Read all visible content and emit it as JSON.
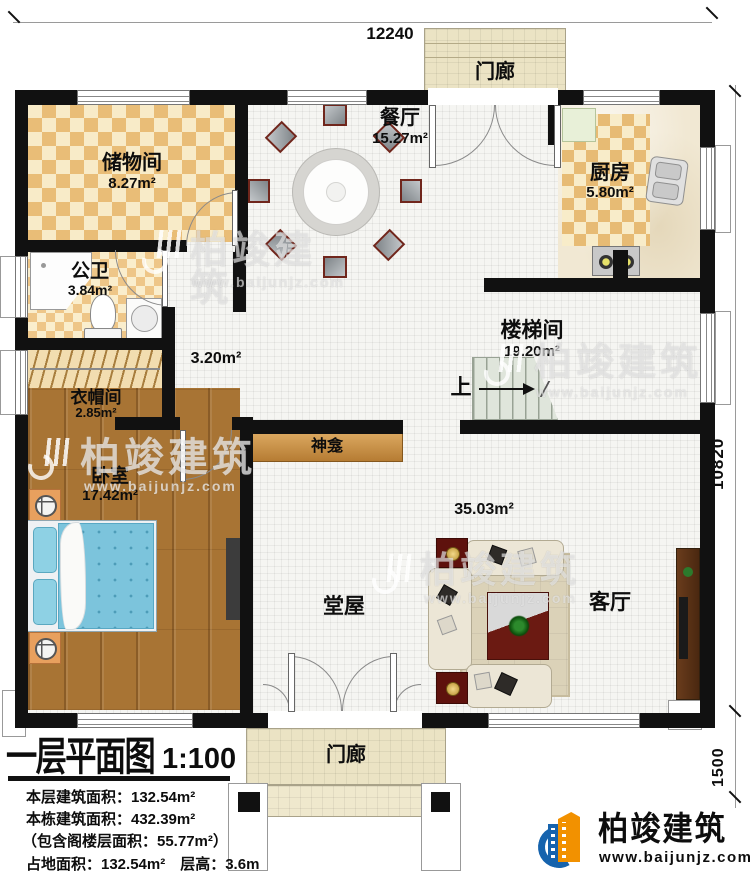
{
  "dimensions": {
    "top": "12240",
    "right_main": "10820",
    "right_porch": "1500"
  },
  "rooms": {
    "storage": {
      "name": "储物间",
      "area": "8.27m²"
    },
    "dining": {
      "name": "餐厅",
      "area": "15.27m²"
    },
    "kitchen": {
      "name": "厨房",
      "area": "5.80m²"
    },
    "bath": {
      "name": "公卫",
      "area": "3.84m²"
    },
    "stair": {
      "name": "楼梯间",
      "area": "19.20m²"
    },
    "cloak": {
      "name": "衣帽间",
      "area": "2.85m²"
    },
    "bedroom": {
      "name": "卧室",
      "area": "17.42m²"
    },
    "hall": {
      "name": "堂屋",
      "area": "35.03m²"
    },
    "living": {
      "name": "客厅"
    },
    "corridor": {
      "area": "3.20m²"
    },
    "shrine": {
      "name": "神龛"
    },
    "porch": {
      "name": "门廊"
    }
  },
  "stairs": {
    "up_label": "上"
  },
  "title_block": {
    "title": "一层平面图",
    "scale": "1:100",
    "lines": [
      "本层建筑面积：132.54m²",
      "本栋建筑面积：432.39m²",
      "（包含阁楼层面积：55.77m²）",
      "占地面积：132.54m²　层高：3.6m"
    ]
  },
  "logo": {
    "name": "柏竣建筑",
    "url": "www.baijunjz.com"
  },
  "watermark": {
    "name": "柏竣建筑",
    "url": "www.baijunjz.com"
  },
  "colors": {
    "wall": "#111111",
    "logo_blue": "#1663ad",
    "logo_orange": "#f29100"
  }
}
